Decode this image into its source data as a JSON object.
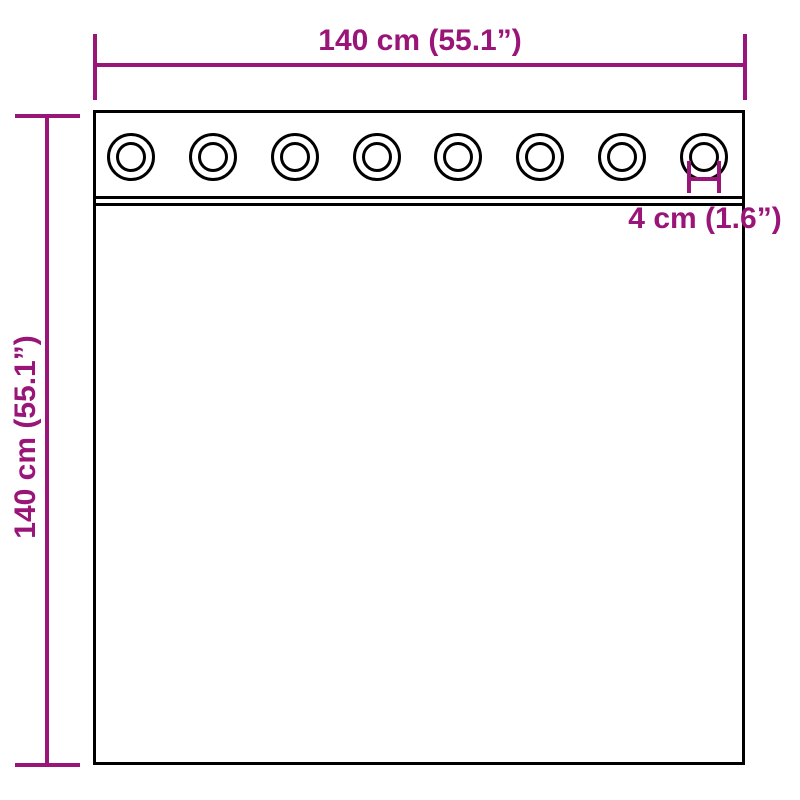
{
  "diagram": {
    "width_label": "140 cm (55.1”)",
    "height_label": "140 cm (55.1”)",
    "grommet_label": "4 cm (1.6”)",
    "grommet_count": 8,
    "colors": {
      "dimension": "#9A1578",
      "outline": "#000000",
      "background": "#FFFFFF"
    }
  }
}
